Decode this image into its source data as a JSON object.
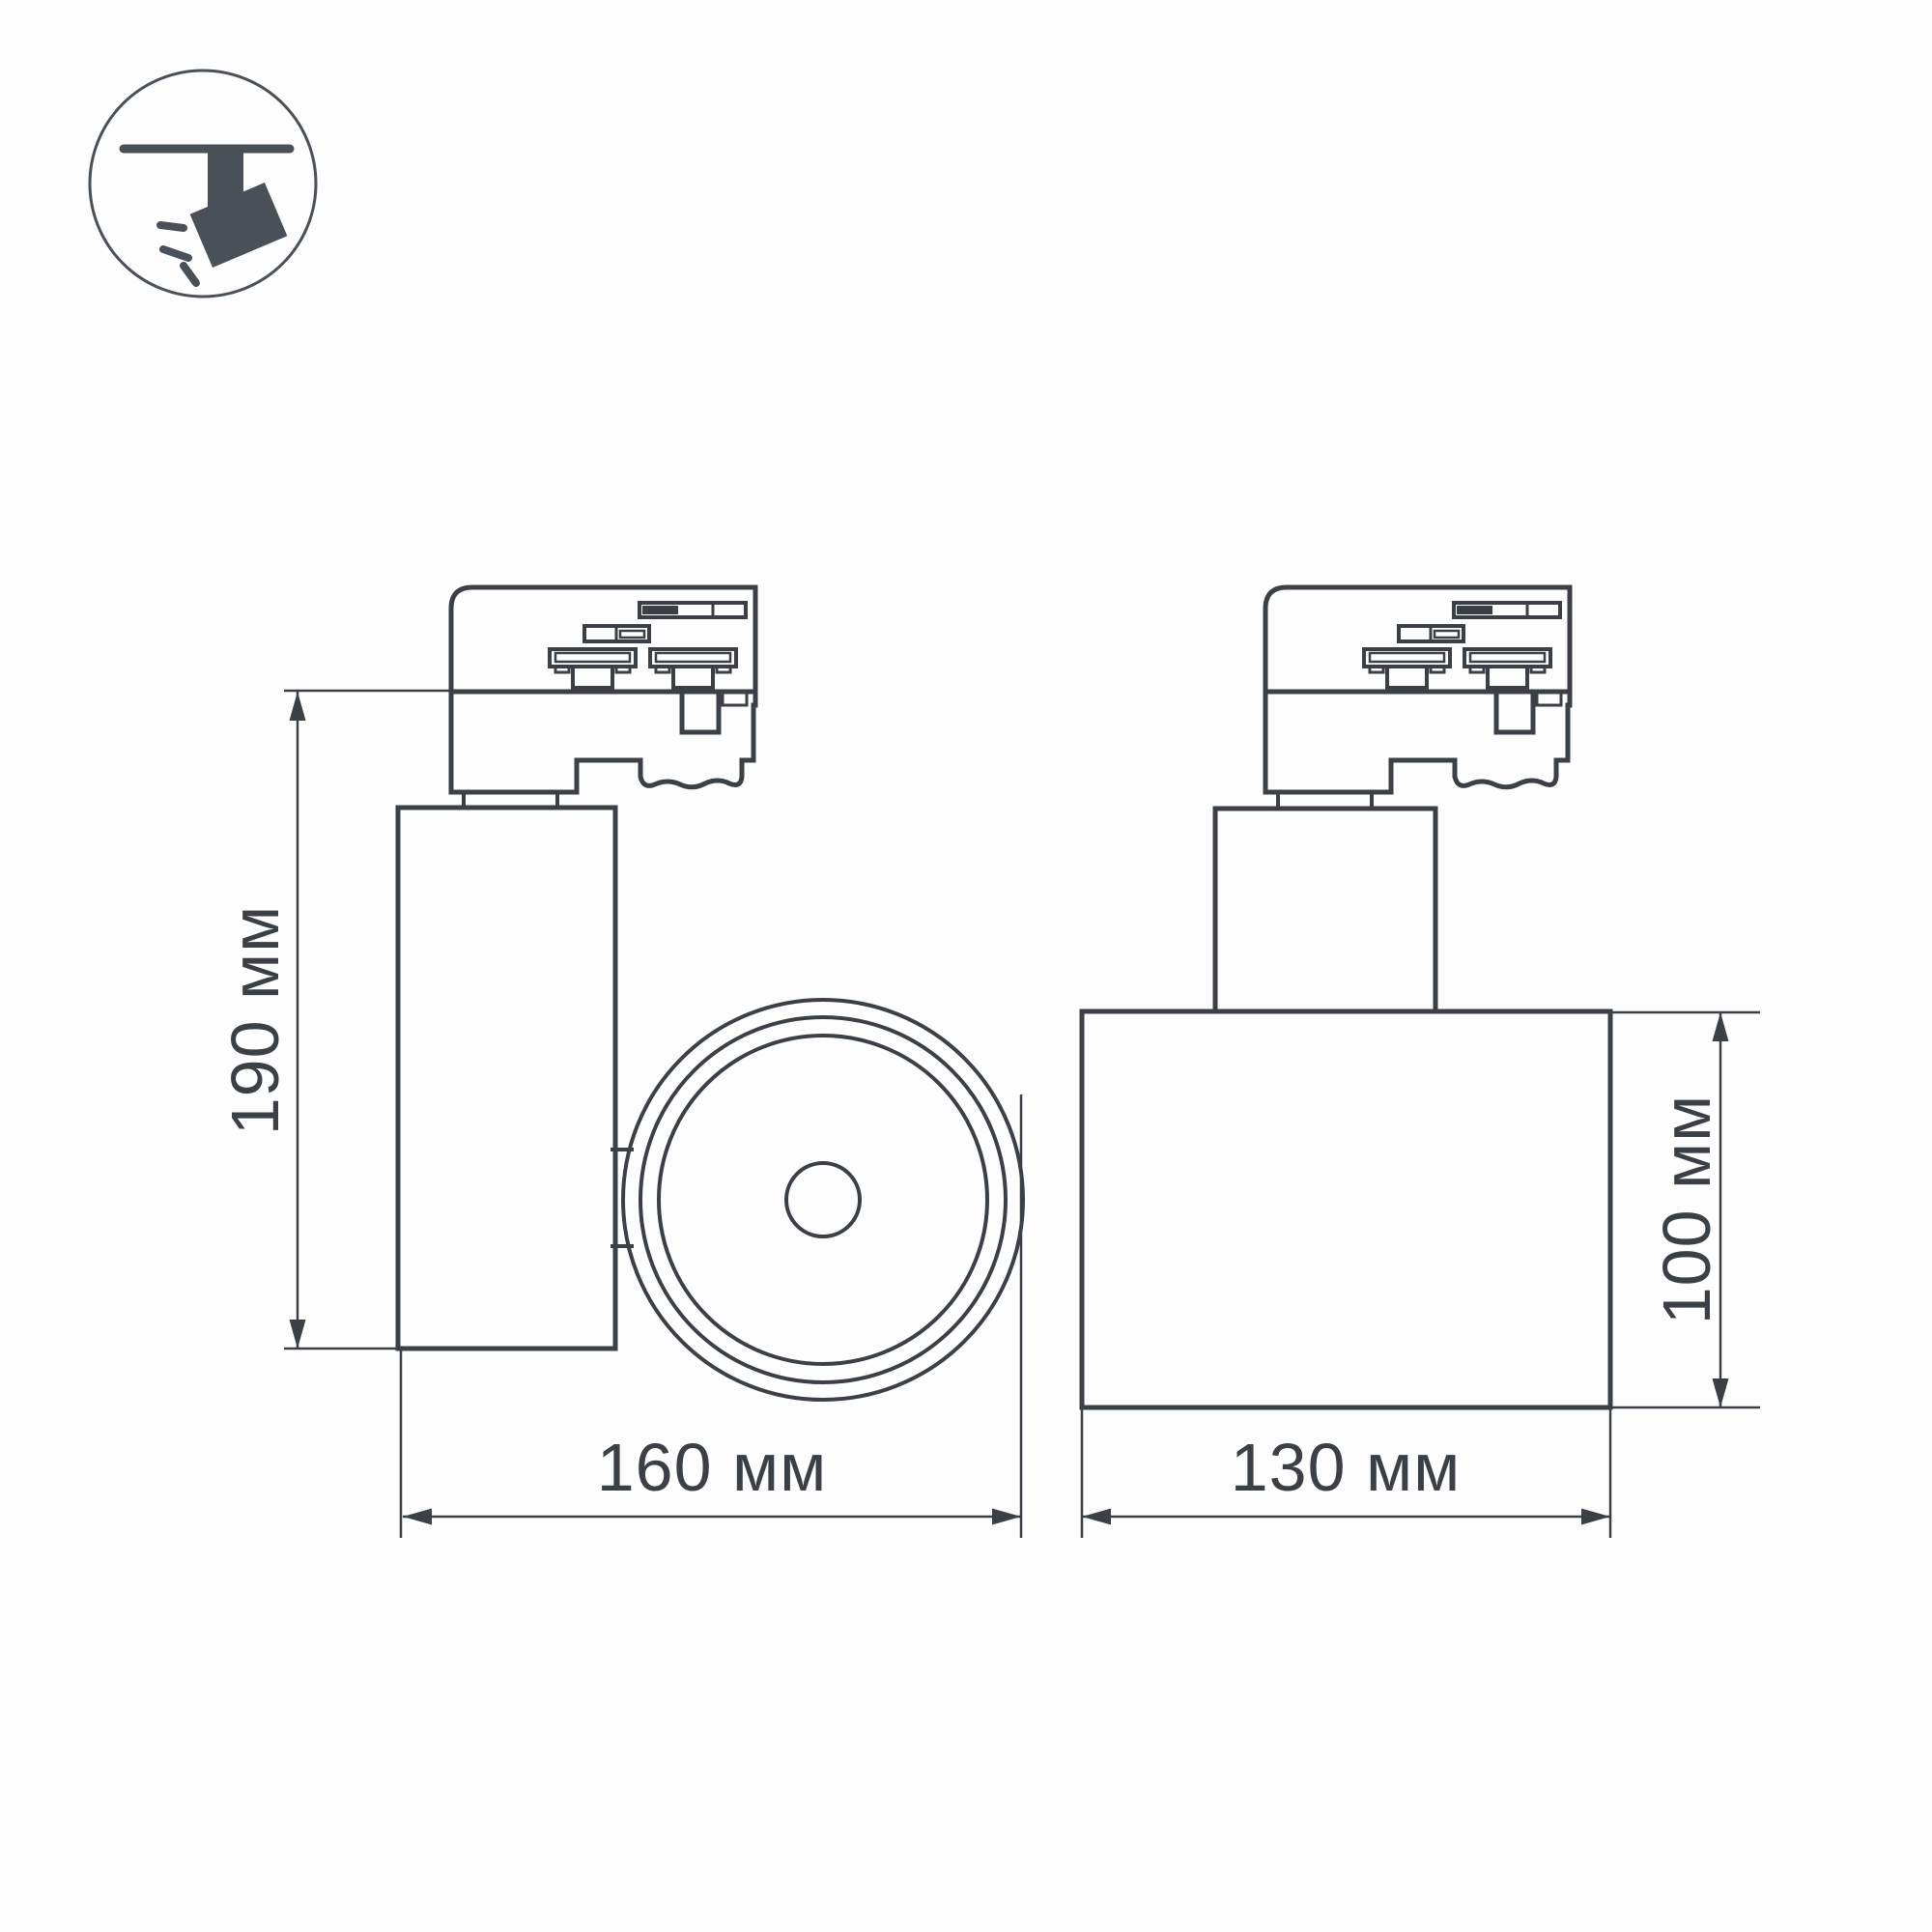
{
  "colors": {
    "background": "#fdfdfd",
    "line": "#3b4046",
    "icon": "#4a5057",
    "text": "#3b4046"
  },
  "icon": {
    "name": "track-spotlight-icon"
  },
  "views": {
    "side": {
      "height_label": "190 мм",
      "width_label": "160 мм"
    },
    "front": {
      "width_label": "130 мм",
      "height_label": "100 мм"
    }
  }
}
